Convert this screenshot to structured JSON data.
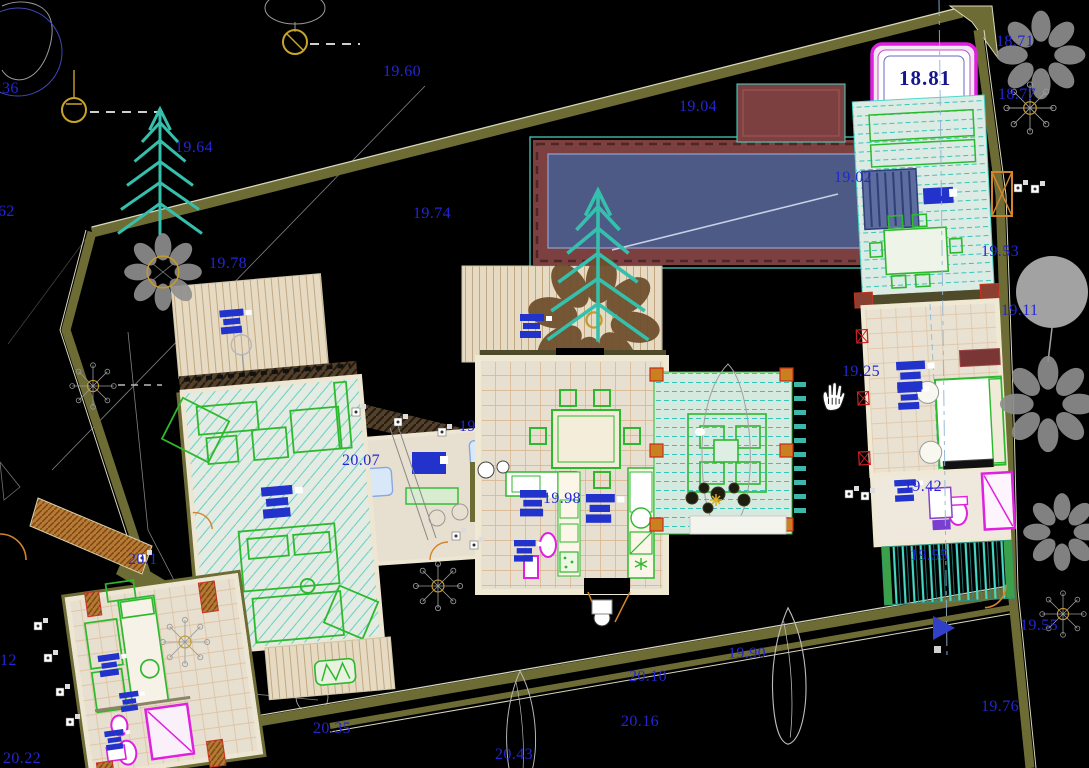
{
  "canvas": {
    "width": 1089,
    "height": 768,
    "background": "#000000"
  },
  "colors": {
    "label_blue": "#2326d6",
    "boxed_label_blue": "#16168c",
    "boundary_wall_olive": "#6e6c35",
    "pool_water": "#4d5a85",
    "pool_border_maroon": "#7d4040",
    "deck_teal": "#38c4b8",
    "furniture_green": "#2db92d",
    "fixture_magenta": "#e020e0",
    "door_orange": "#d4842c",
    "floor_beige": "#e7dfcf",
    "tree_gray": "#9a9a9a",
    "survey_marker_yellow": "#c8a427",
    "text_block_blue": "#2233cc"
  },
  "cursor": {
    "icon": "pan-hand",
    "x": 818,
    "y": 380
  },
  "spot_levels": [
    {
      "text": "36",
      "x": 2,
      "y": 80
    },
    {
      "text": "62",
      "x": -2,
      "y": 203
    },
    {
      "text": "19.60",
      "x": 383,
      "y": 63
    },
    {
      "text": "19.04",
      "x": 679,
      "y": 98
    },
    {
      "text": "19.64",
      "x": 175,
      "y": 139
    },
    {
      "text": "19.74",
      "x": 413,
      "y": 205
    },
    {
      "text": "19.78",
      "x": 209,
      "y": 255
    },
    {
      "text": "19.02",
      "x": 834,
      "y": 169
    },
    {
      "text": "18.71",
      "x": 996,
      "y": 33
    },
    {
      "text": "18.77",
      "x": 998,
      "y": 86
    },
    {
      "text": "18.81",
      "x": 899,
      "y": 66,
      "boxed": true
    },
    {
      "text": "19.53",
      "x": 981,
      "y": 243
    },
    {
      "text": "19.11",
      "x": 1001,
      "y": 302
    },
    {
      "text": "19.25",
      "x": 842,
      "y": 363
    },
    {
      "text": "20.07",
      "x": 342,
      "y": 452
    },
    {
      "text": "19",
      "x": 459,
      "y": 418
    },
    {
      "text": "19.98",
      "x": 543,
      "y": 490
    },
    {
      "text": "19.42",
      "x": 904,
      "y": 478
    },
    {
      "text": "20.1",
      "x": 128,
      "y": 551
    },
    {
      "text": "19.55",
      "x": 910,
      "y": 547
    },
    {
      "text": "19.55",
      "x": 1020,
      "y": 617
    },
    {
      "text": "19.90",
      "x": 728,
      "y": 645
    },
    {
      "text": "20.10",
      "x": 629,
      "y": 668
    },
    {
      "text": "20.16",
      "x": 621,
      "y": 713
    },
    {
      "text": "20.35",
      "x": 313,
      "y": 720
    },
    {
      "text": "20.43",
      "x": 495,
      "y": 746
    },
    {
      "text": "19.76",
      "x": 981,
      "y": 698
    },
    {
      "text": "12",
      "x": 0,
      "y": 652
    },
    {
      "text": "20.22",
      "x": 3,
      "y": 750
    }
  ]
}
